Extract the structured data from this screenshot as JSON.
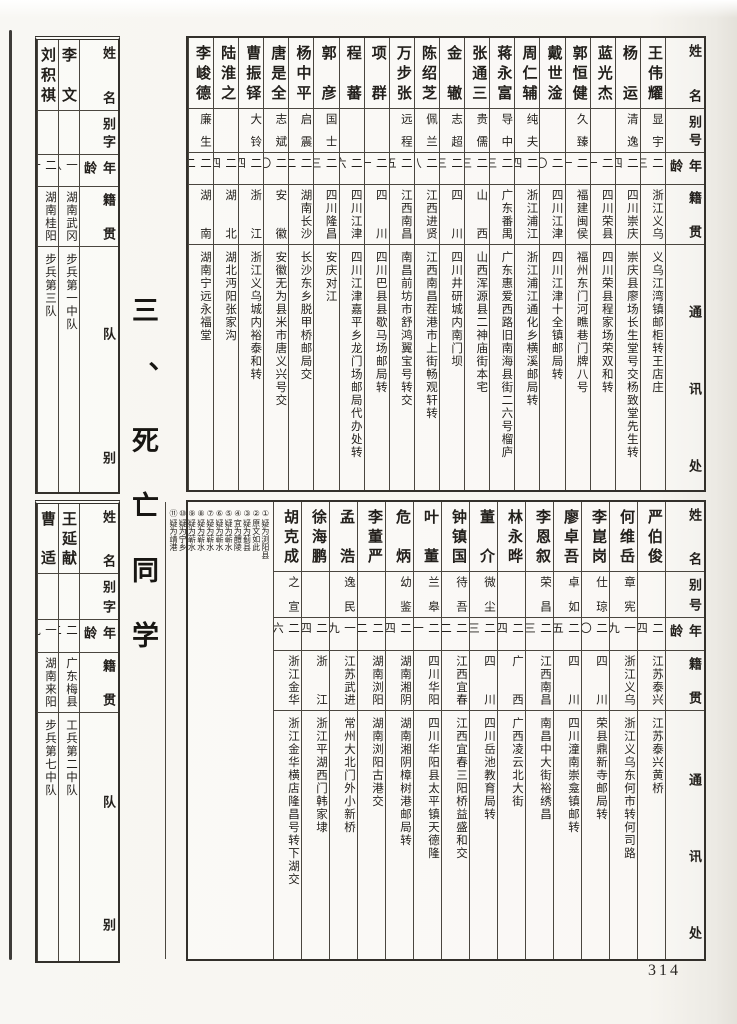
{
  "page": {
    "number": "314",
    "section_title": "三、死亡同学"
  },
  "right_top_table": {
    "headers": {
      "name": "姓名",
      "alias": "别号",
      "age": "年龄",
      "origin": "籍贯",
      "address": "通讯处"
    },
    "entries": [
      {
        "name": "王伟耀",
        "alias": "显宇",
        "age": "二三",
        "origin": "浙江义乌",
        "address": "义乌江湾镇邮柜转王店庄"
      },
      {
        "name": "杨运",
        "alias": "清逸",
        "age": "二四",
        "origin": "四川崇庆",
        "address": "崇庆县廖场长生堂号交杨致堂先生转"
      },
      {
        "name": "蓝光杰",
        "alias": "",
        "age": "二一",
        "origin": "四川荣县",
        "address": "四川荣县程家场荣双和转"
      },
      {
        "name": "郭恒健",
        "alias": "久臻",
        "age": "二一",
        "origin": "福建闽侯",
        "address": "福州东门河瞧巷门牌八号"
      },
      {
        "name": "戴世淦",
        "alias": "",
        "age": "二〇",
        "origin": "四川江津",
        "address": "四川江津十全镇邮局转"
      },
      {
        "name": "周仁辅",
        "alias": "纯夫",
        "age": "二四",
        "origin": "浙江浦江",
        "address": "浙江浦江通化乡横溪邮局转"
      },
      {
        "name": "蒋永富",
        "alias": "导中",
        "age": "二三",
        "origin": "广东番禺",
        "address": "广东惠爱西路旧南海县街二六号榴庐"
      },
      {
        "name": "张通三",
        "alias": "贵儒",
        "age": "二三",
        "origin": "山西",
        "address": "山西浑源县二神庙街本宅"
      },
      {
        "name": "金辙",
        "alias": "志超",
        "age": "二三",
        "origin": "四川",
        "address": "四川井研城内南门坝"
      },
      {
        "name": "陈绍芝",
        "alias": "佩兰",
        "age": "二八",
        "origin": "江西进贤",
        "address": "江西南昌茬港市上街畅观轩转"
      },
      {
        "name": "万步张",
        "alias": "远程",
        "age": "二五",
        "origin": "江西南昌",
        "address": "南昌前坊市舒鸿翼宝号转交"
      },
      {
        "name": "项群",
        "alias": "",
        "age": "二一",
        "origin": "四川",
        "address": "四川巴县县歇马场邮局转"
      },
      {
        "name": "程蕃",
        "alias": "",
        "age": "二六",
        "origin": "四川江津",
        "address": "四川江津嘉平乡龙门场邮局代办处转"
      },
      {
        "name": "郭彦",
        "alias": "国士",
        "age": "二三",
        "origin": "四川隆昌",
        "address": "安庆对江"
      },
      {
        "name": "杨中平",
        "alias": "启震",
        "age": "二二",
        "origin": "湖南长沙",
        "address": "长沙东乡脱甲桥邮局交"
      },
      {
        "name": "唐是全",
        "alias": "志斌",
        "age": "二〇",
        "origin": "安徽",
        "address": "安徽无为县米市唐义兴号交"
      },
      {
        "name": "曹振铎",
        "alias": "大铃",
        "age": "二四",
        "origin": "浙江",
        "address": "浙江义乌城内裕泰和转"
      },
      {
        "name": "陆淮之",
        "alias": "",
        "age": "二四",
        "origin": "湖北",
        "address": "湖北沔阳张家沟"
      },
      {
        "name": "李峻德",
        "alias": "廉生",
        "age": "二二",
        "origin": "湖南",
        "address": "湖南宁远永福堂"
      }
    ]
  },
  "right_bottom_table": {
    "headers": {
      "name": "姓名",
      "alias": "别号",
      "age": "年龄",
      "origin": "籍贯",
      "address": "通讯处"
    },
    "entries": [
      {
        "name": "严伯俊",
        "alias": "",
        "age": "二四",
        "origin": "江苏泰兴",
        "address": "江苏泰兴黄桥"
      },
      {
        "name": "何维岳",
        "alias": "章宪",
        "age": "一九",
        "origin": "浙江义乌",
        "address": "浙江义乌东何市转何司路"
      },
      {
        "name": "李崑岗",
        "alias": "仕琼",
        "age": "二〇",
        "origin": "四川",
        "address": "荣县鼎新寺邮局转"
      },
      {
        "name": "廖卓吾",
        "alias": "卓如",
        "age": "二五",
        "origin": "四川",
        "address": "四川潼南崇龛镇邮转"
      },
      {
        "name": "李恩叙",
        "alias": "荣昌",
        "age": "二三",
        "origin": "江西南昌",
        "address": "南昌中大街裕绣昌"
      },
      {
        "name": "林永晔",
        "alias": "",
        "age": "二四",
        "origin": "广西",
        "address": "广西凌云北大街"
      },
      {
        "name": "董介",
        "alias": "微尘",
        "age": "二三",
        "origin": "四川",
        "address": "四川岳池教育局转"
      },
      {
        "name": "钟镇国",
        "alias": "待吾",
        "age": "二二",
        "origin": "江西宜春",
        "address": "江西宜春三阳桥益盛和交"
      },
      {
        "name": "叶董",
        "alias": "兰皋",
        "age": "二一",
        "origin": "四川华阳",
        "address": "四川华阳县太平镇天德隆"
      },
      {
        "name": "危炳",
        "alias": "幼鉴",
        "age": "二四",
        "origin": "湖南湘阴",
        "address": "湖南湘阴樟树港邮局转"
      },
      {
        "name": "李董严",
        "alias": "",
        "age": "二二",
        "origin": "湖南浏阳",
        "address": "湖南浏阳古港交"
      },
      {
        "name": "孟浩",
        "alias": "逸民",
        "age": "一九",
        "origin": "江苏武进",
        "address": "常州大北门外小新桥"
      },
      {
        "name": "徐海鹏",
        "alias": "",
        "age": "二四",
        "origin": "浙江",
        "address": "浙江平湖西门韩家埭"
      },
      {
        "name": "胡克成",
        "alias": "之宣",
        "age": "二六",
        "origin": "浙江金华",
        "address": "浙江金华横店隆昌号转下湖交"
      }
    ],
    "notes": [
      {
        "n": "①",
        "t": "疑为浏阳县"
      },
      {
        "n": "②",
        "t": "原文如此"
      },
      {
        "n": "③",
        "t": "疑为蓟县"
      },
      {
        "n": "④",
        "t": "宜为醴陵"
      },
      {
        "n": "⑤",
        "t": "疑为蕲水"
      },
      {
        "n": "⑥",
        "t": "疑为蕲水"
      },
      {
        "n": "⑦",
        "t": "疑为蕲水"
      },
      {
        "n": "⑧",
        "t": "疑为蕲水"
      },
      {
        "n": "⑨",
        "t": "疑为蕲水"
      },
      {
        "n": "⑩",
        "t": "疑为宁乡"
      },
      {
        "n": "⑪",
        "t": "疑为靖港"
      }
    ]
  },
  "left_top_table": {
    "headers": {
      "name": "姓名",
      "alias": "别字",
      "age": "年龄",
      "origin": "籍贯",
      "unit": "队别"
    },
    "entries": [
      {
        "name": "李文",
        "alias": "",
        "age": "一八",
        "origin": "湖南武冈",
        "unit": "步兵第一中队"
      },
      {
        "name": "刘积祺",
        "alias": "",
        "age": "二一",
        "origin": "湖南桂阳",
        "unit": "步兵第三队"
      }
    ]
  },
  "left_bottom_table": {
    "headers": {
      "name": "姓名",
      "alias": "别字",
      "age": "年龄",
      "origin": "籍贯",
      "unit": "队别"
    },
    "entries": [
      {
        "name": "王延献",
        "alias": "",
        "age": "二二",
        "origin": "广东梅县",
        "unit": "工兵第二中队"
      },
      {
        "name": "曹适",
        "alias": "",
        "age": "一九",
        "origin": "湖南来阳",
        "unit": "步兵第七中队"
      }
    ]
  }
}
